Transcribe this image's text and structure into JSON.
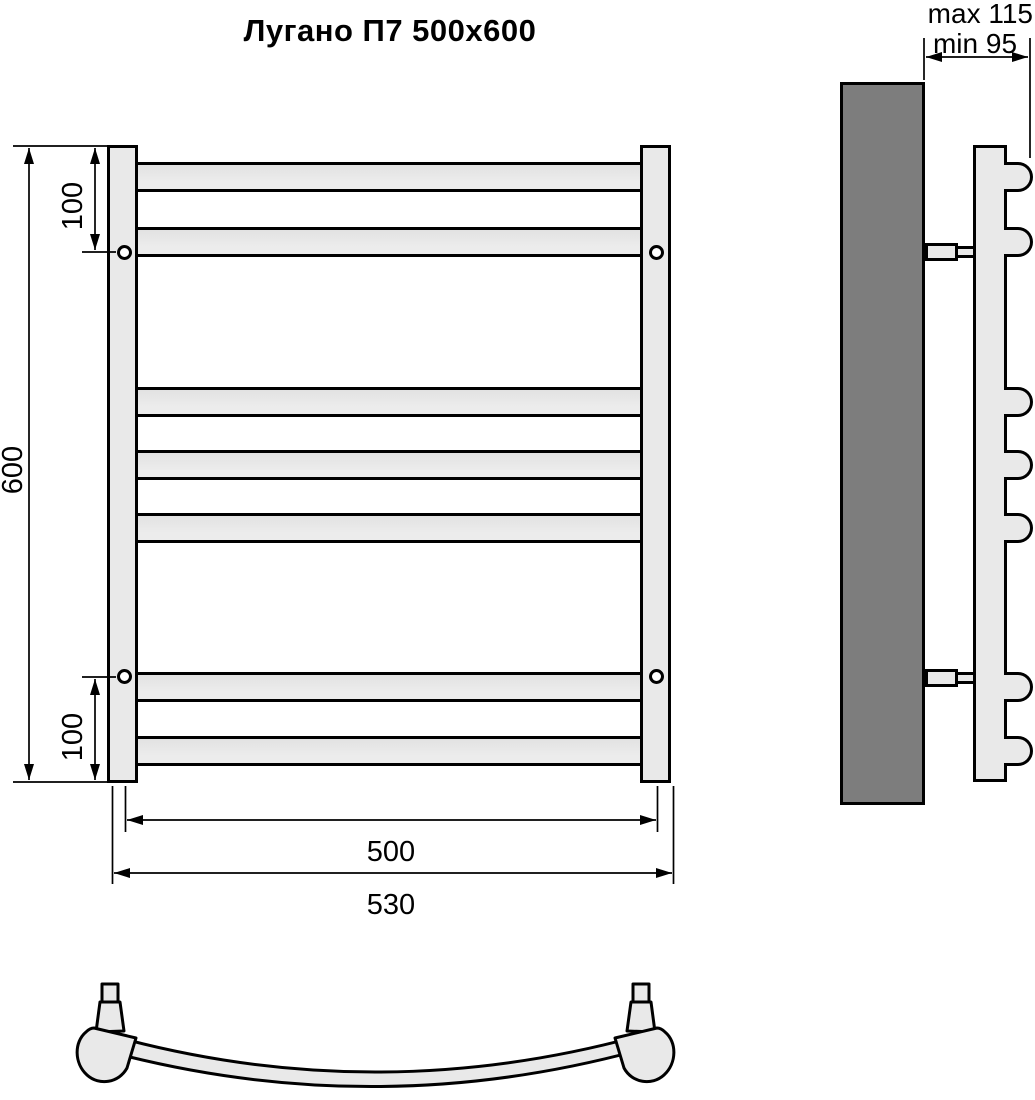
{
  "title": "Лугано П7 500x600",
  "front_view": {
    "height_label": "600",
    "top_offset_label": "100",
    "bottom_offset_label": "100",
    "mount_width_label": "500",
    "overall_width_label": "530",
    "rung_count": 7
  },
  "side_view": {
    "max_depth_label": "max 115",
    "min_depth_label": "min 95"
  },
  "colors": {
    "tube": "#e9e9e9",
    "wall": "#7d7d7d",
    "line": "#000000",
    "background": "#ffffff"
  }
}
